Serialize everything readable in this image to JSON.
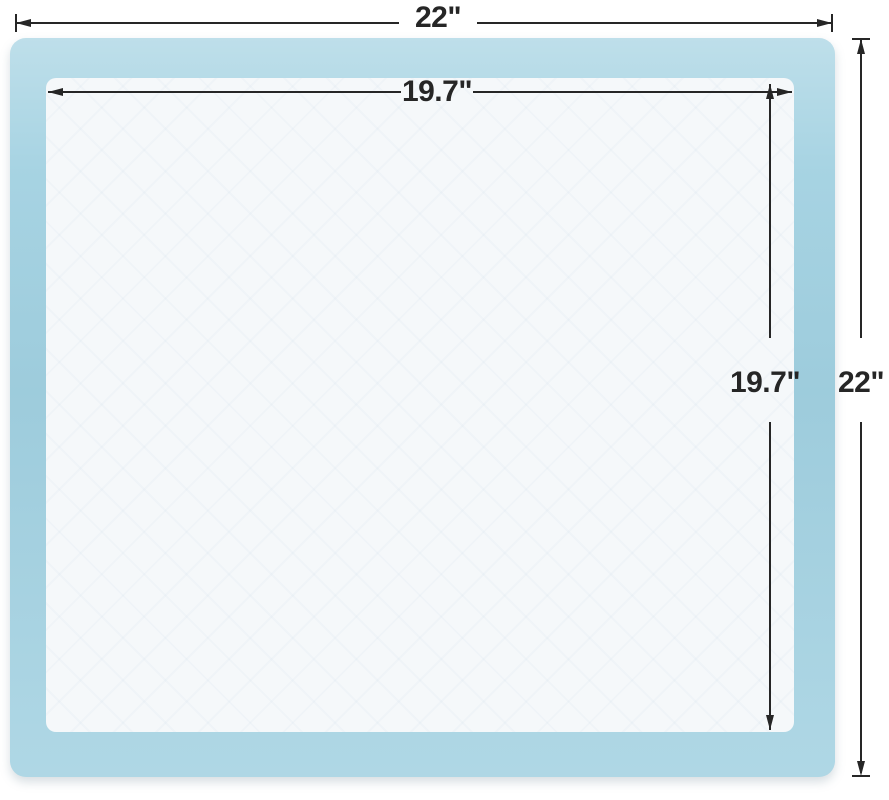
{
  "diagram": {
    "dimensions": {
      "outer_width": "22\"",
      "inner_width": "19.7\"",
      "inner_height": "19.7\"",
      "outer_height": "22\""
    },
    "colors": {
      "pad-blue": "#a2d1e1",
      "pad-core": "#f5f8fa",
      "dim-line": "#262626",
      "page-bg": "#ffffff"
    }
  }
}
